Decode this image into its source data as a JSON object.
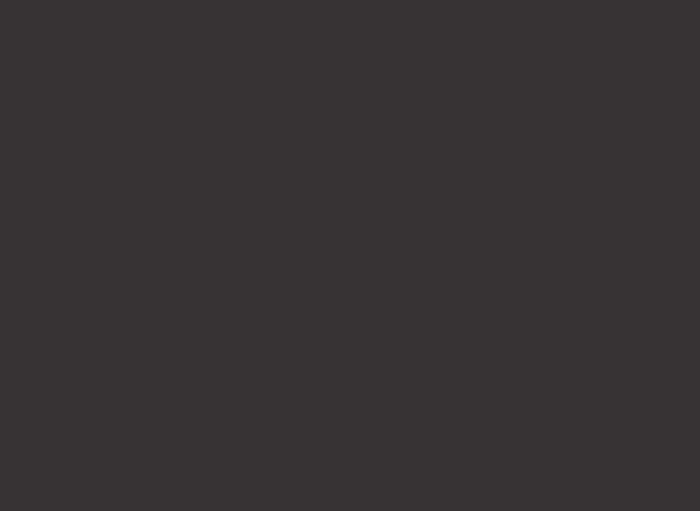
{
  "screen": {
    "description": "blank dark display, no visible UI elements",
    "background_color": "#363334",
    "background_style": "background-color:#363334;"
  }
}
